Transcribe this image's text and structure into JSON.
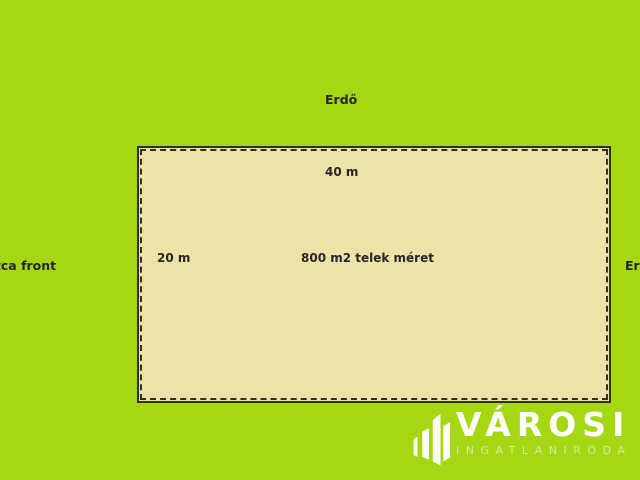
{
  "diagram": {
    "surroundings": {
      "top_label": "Erdő",
      "left_label": "utca front",
      "right_label": "Erdő"
    },
    "plot": {
      "width_label": "40 m",
      "depth_label": "20 m",
      "area_label": "800 m2 telek méret"
    }
  },
  "branding": {
    "company": "VÁROSI",
    "tagline": "INGATLANIRODA",
    "icon": "buildings-icon"
  },
  "colors": {
    "background": "#a6d715",
    "plot_fill": "#ede2a7",
    "plot_border": "#2e2e2e",
    "label_text": "#26252b",
    "logo_text": "#ffffff"
  }
}
